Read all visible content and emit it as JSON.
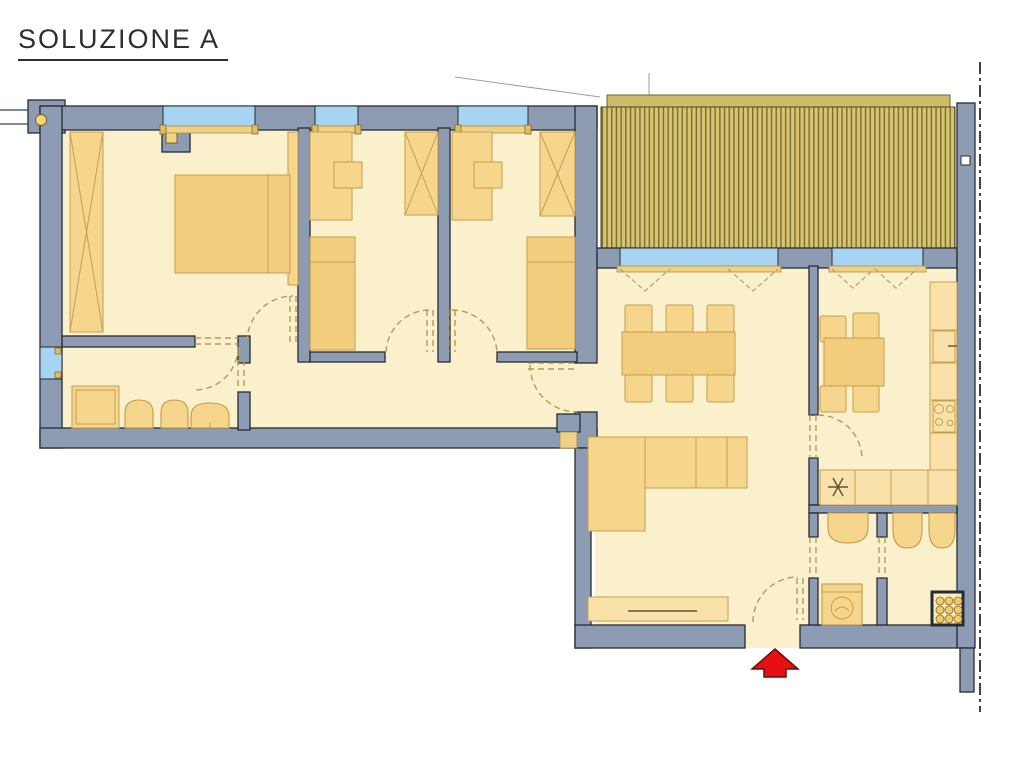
{
  "title": "SOLUZIONE A",
  "colors": {
    "wall": "#8d9cb3",
    "wallStroke": "#272b33",
    "floor": "#faf0cb",
    "furn": "#f6d68d",
    "furnStroke": "#c69f4e",
    "furnLight": "#f8e2a9",
    "furnDark": "#f2cd7d",
    "win": "#a6d4f2",
    "sill": "#eed184",
    "terrace": "#d8c572",
    "terraceStripe": "#7e7034",
    "terraceBand": "#ccbd68",
    "dash": "#b69a5a",
    "red": "#e60f13",
    "redStroke": "#6b0b0b",
    "boundary": "#3d434d",
    "marker": "#f2d57c",
    "leader": "#9aa0a8",
    "titleColor": "#2e2e2e",
    "background": "#ffffff"
  }
}
